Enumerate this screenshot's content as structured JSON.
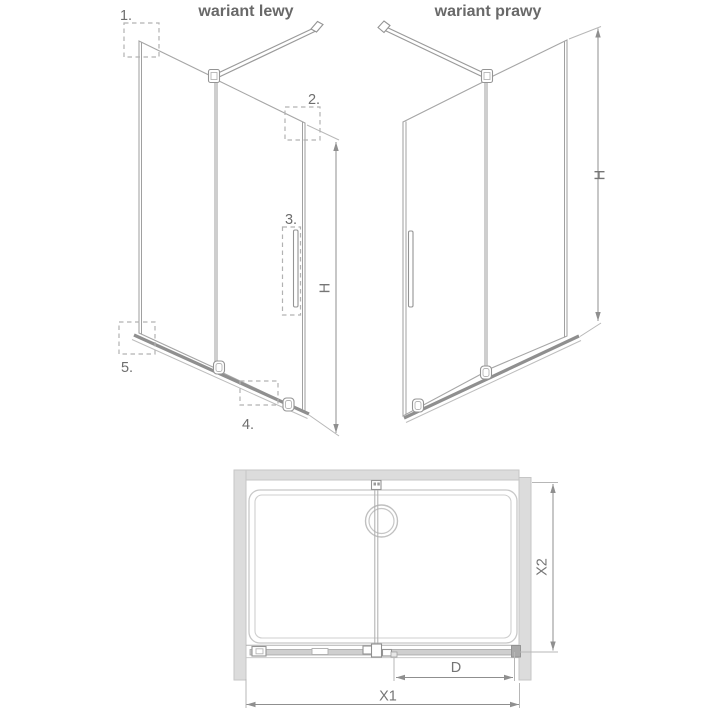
{
  "left_variant": {
    "title": "wariant lewy",
    "height_label": "H",
    "callouts": [
      {
        "label": "1."
      },
      {
        "label": "2."
      },
      {
        "label": "3."
      },
      {
        "label": "4."
      },
      {
        "label": "5."
      }
    ]
  },
  "right_variant": {
    "title": "wariant prawy",
    "height_label": "H"
  },
  "plan_view": {
    "total_width_label": "X1",
    "depth_label": "X2",
    "door_width_label": "D"
  },
  "colors": {
    "wall_fill": "#dcdcdc",
    "line_gray": "#9a9a9a",
    "text_gray": "#6a6a6a",
    "background": "#ffffff"
  }
}
